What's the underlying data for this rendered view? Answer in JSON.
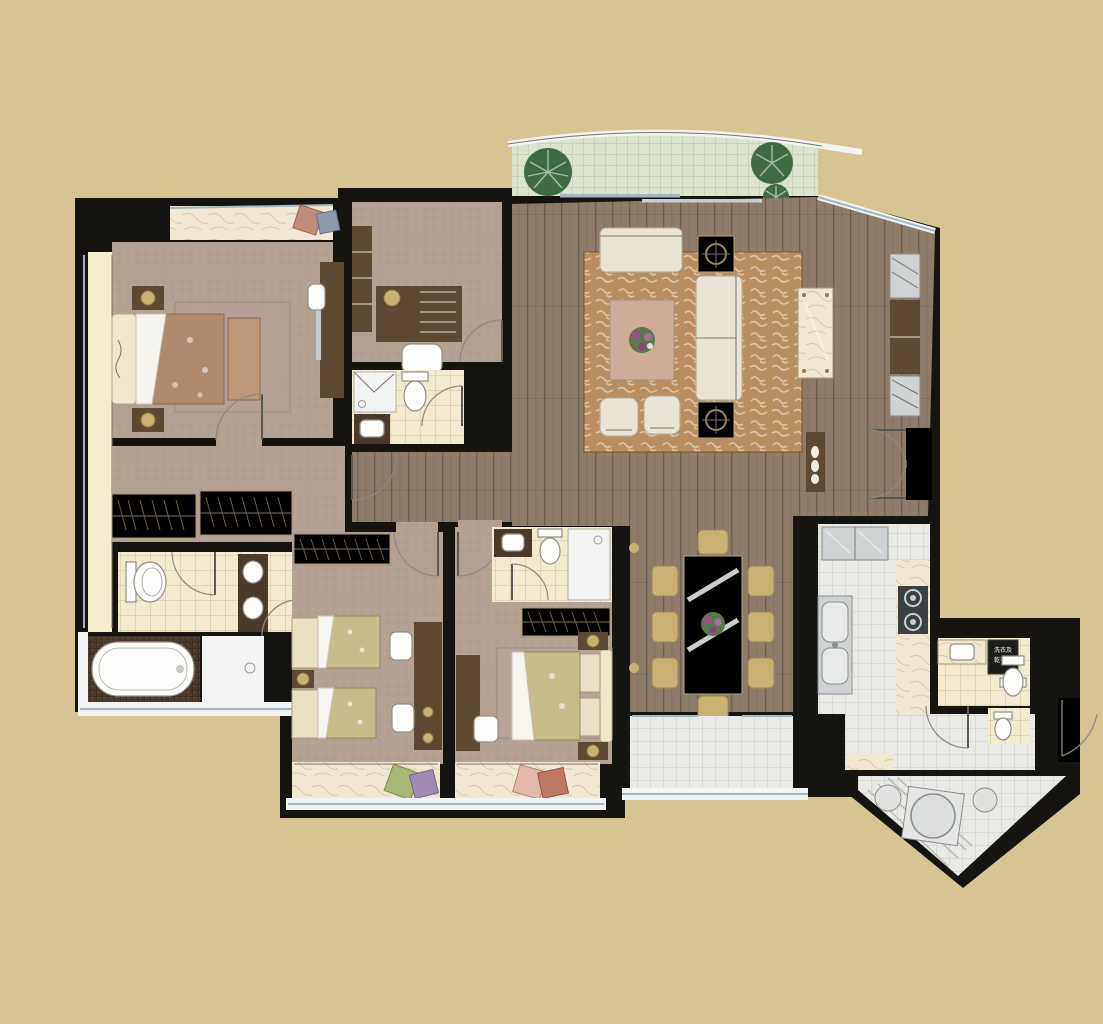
{
  "type": "residential-floor-plan",
  "labels": {
    "washer_unit_line1": "洗衣及",
    "washer_unit_line2": "乾衣機"
  },
  "palette": {
    "bg": "#d6c592",
    "wall": "#161411",
    "wood": "#8d7c69",
    "woodLine": "#6e6050",
    "carpet": "#b3a193",
    "tileCream": "#f2ebcf",
    "tileCreamLine": "#cfc29b",
    "tileGray": "#e9eae6",
    "tileGrayLine": "#c7c9c4",
    "tileGreen": "#dce3cf",
    "tileGreenLine": "#b4c1a7",
    "marble": "#f0e8d3",
    "counter": "#4b3a2b",
    "furn": "#5e4a33",
    "gold": "#c8b173",
    "sofa": "#eae4d4",
    "rug": "#b98f62",
    "white": "#f2f4f3",
    "window": "#a3b6c1",
    "plant": "#3e6b41"
  },
  "rooms": [
    {
      "name": "balcony-top",
      "furniture": [
        "plants",
        "green floor tiles",
        "curved railing"
      ]
    },
    {
      "name": "living-room",
      "furniture": [
        "sectional sofa",
        "chaise",
        "two armchairs",
        "coffee table with flowers",
        "patterned rug",
        "two side tables",
        "marble console",
        "wall cabinets",
        "shoe cabinet"
      ]
    },
    {
      "name": "dining-room",
      "furniture": [
        "dining table for eight",
        "flower centerpiece",
        "eight chairs"
      ]
    },
    {
      "name": "dining-terrace",
      "furniture": [
        "tiled floor",
        "railing"
      ]
    },
    {
      "name": "master-bedroom",
      "furniture": [
        "double bed",
        "headboard",
        "two nightstands with lamps",
        "foot bench",
        "rug",
        "tv console",
        "bench",
        "bay window with cushions"
      ]
    },
    {
      "name": "walk-in-closet",
      "furniture": [
        "two wardrobes with hangers"
      ]
    },
    {
      "name": "master-bathroom",
      "furniture": [
        "toilet",
        "double sink vanity",
        "bathtub",
        "shower"
      ]
    },
    {
      "name": "study",
      "furniture": [
        "desk",
        "desk lamp",
        "chair",
        "bookshelf"
      ]
    },
    {
      "name": "study-bathroom",
      "furniture": [
        "shower",
        "toilet",
        "vanity sink"
      ]
    },
    {
      "name": "kids-bedroom",
      "furniture": [
        "two single beds",
        "nightstand with lamp",
        "desk",
        "two chairs",
        "wardrobe",
        "bay window with cushions"
      ]
    },
    {
      "name": "second-bedroom",
      "furniture": [
        "double bed",
        "rug",
        "two nightstands",
        "desk",
        "chair",
        "wardrobe",
        "bay window with cushions"
      ]
    },
    {
      "name": "second-bathroom",
      "furniture": [
        "vanity sink",
        "toilet",
        "shower"
      ]
    },
    {
      "name": "kitchen",
      "furniture": [
        "refrigerator",
        "double sink",
        "cooktop with two burners",
        "marble counter"
      ]
    },
    {
      "name": "utility-bathroom",
      "furniture": [
        "sink counter",
        "washer-dryer unit",
        "toilet",
        "second toilet"
      ]
    },
    {
      "name": "entry-foyer",
      "furniture": [
        "double entry doors",
        "threshold"
      ]
    },
    {
      "name": "service-balcony",
      "furniture": [
        "washing machine",
        "two basins",
        "drying lines",
        "exterior door"
      ]
    }
  ]
}
